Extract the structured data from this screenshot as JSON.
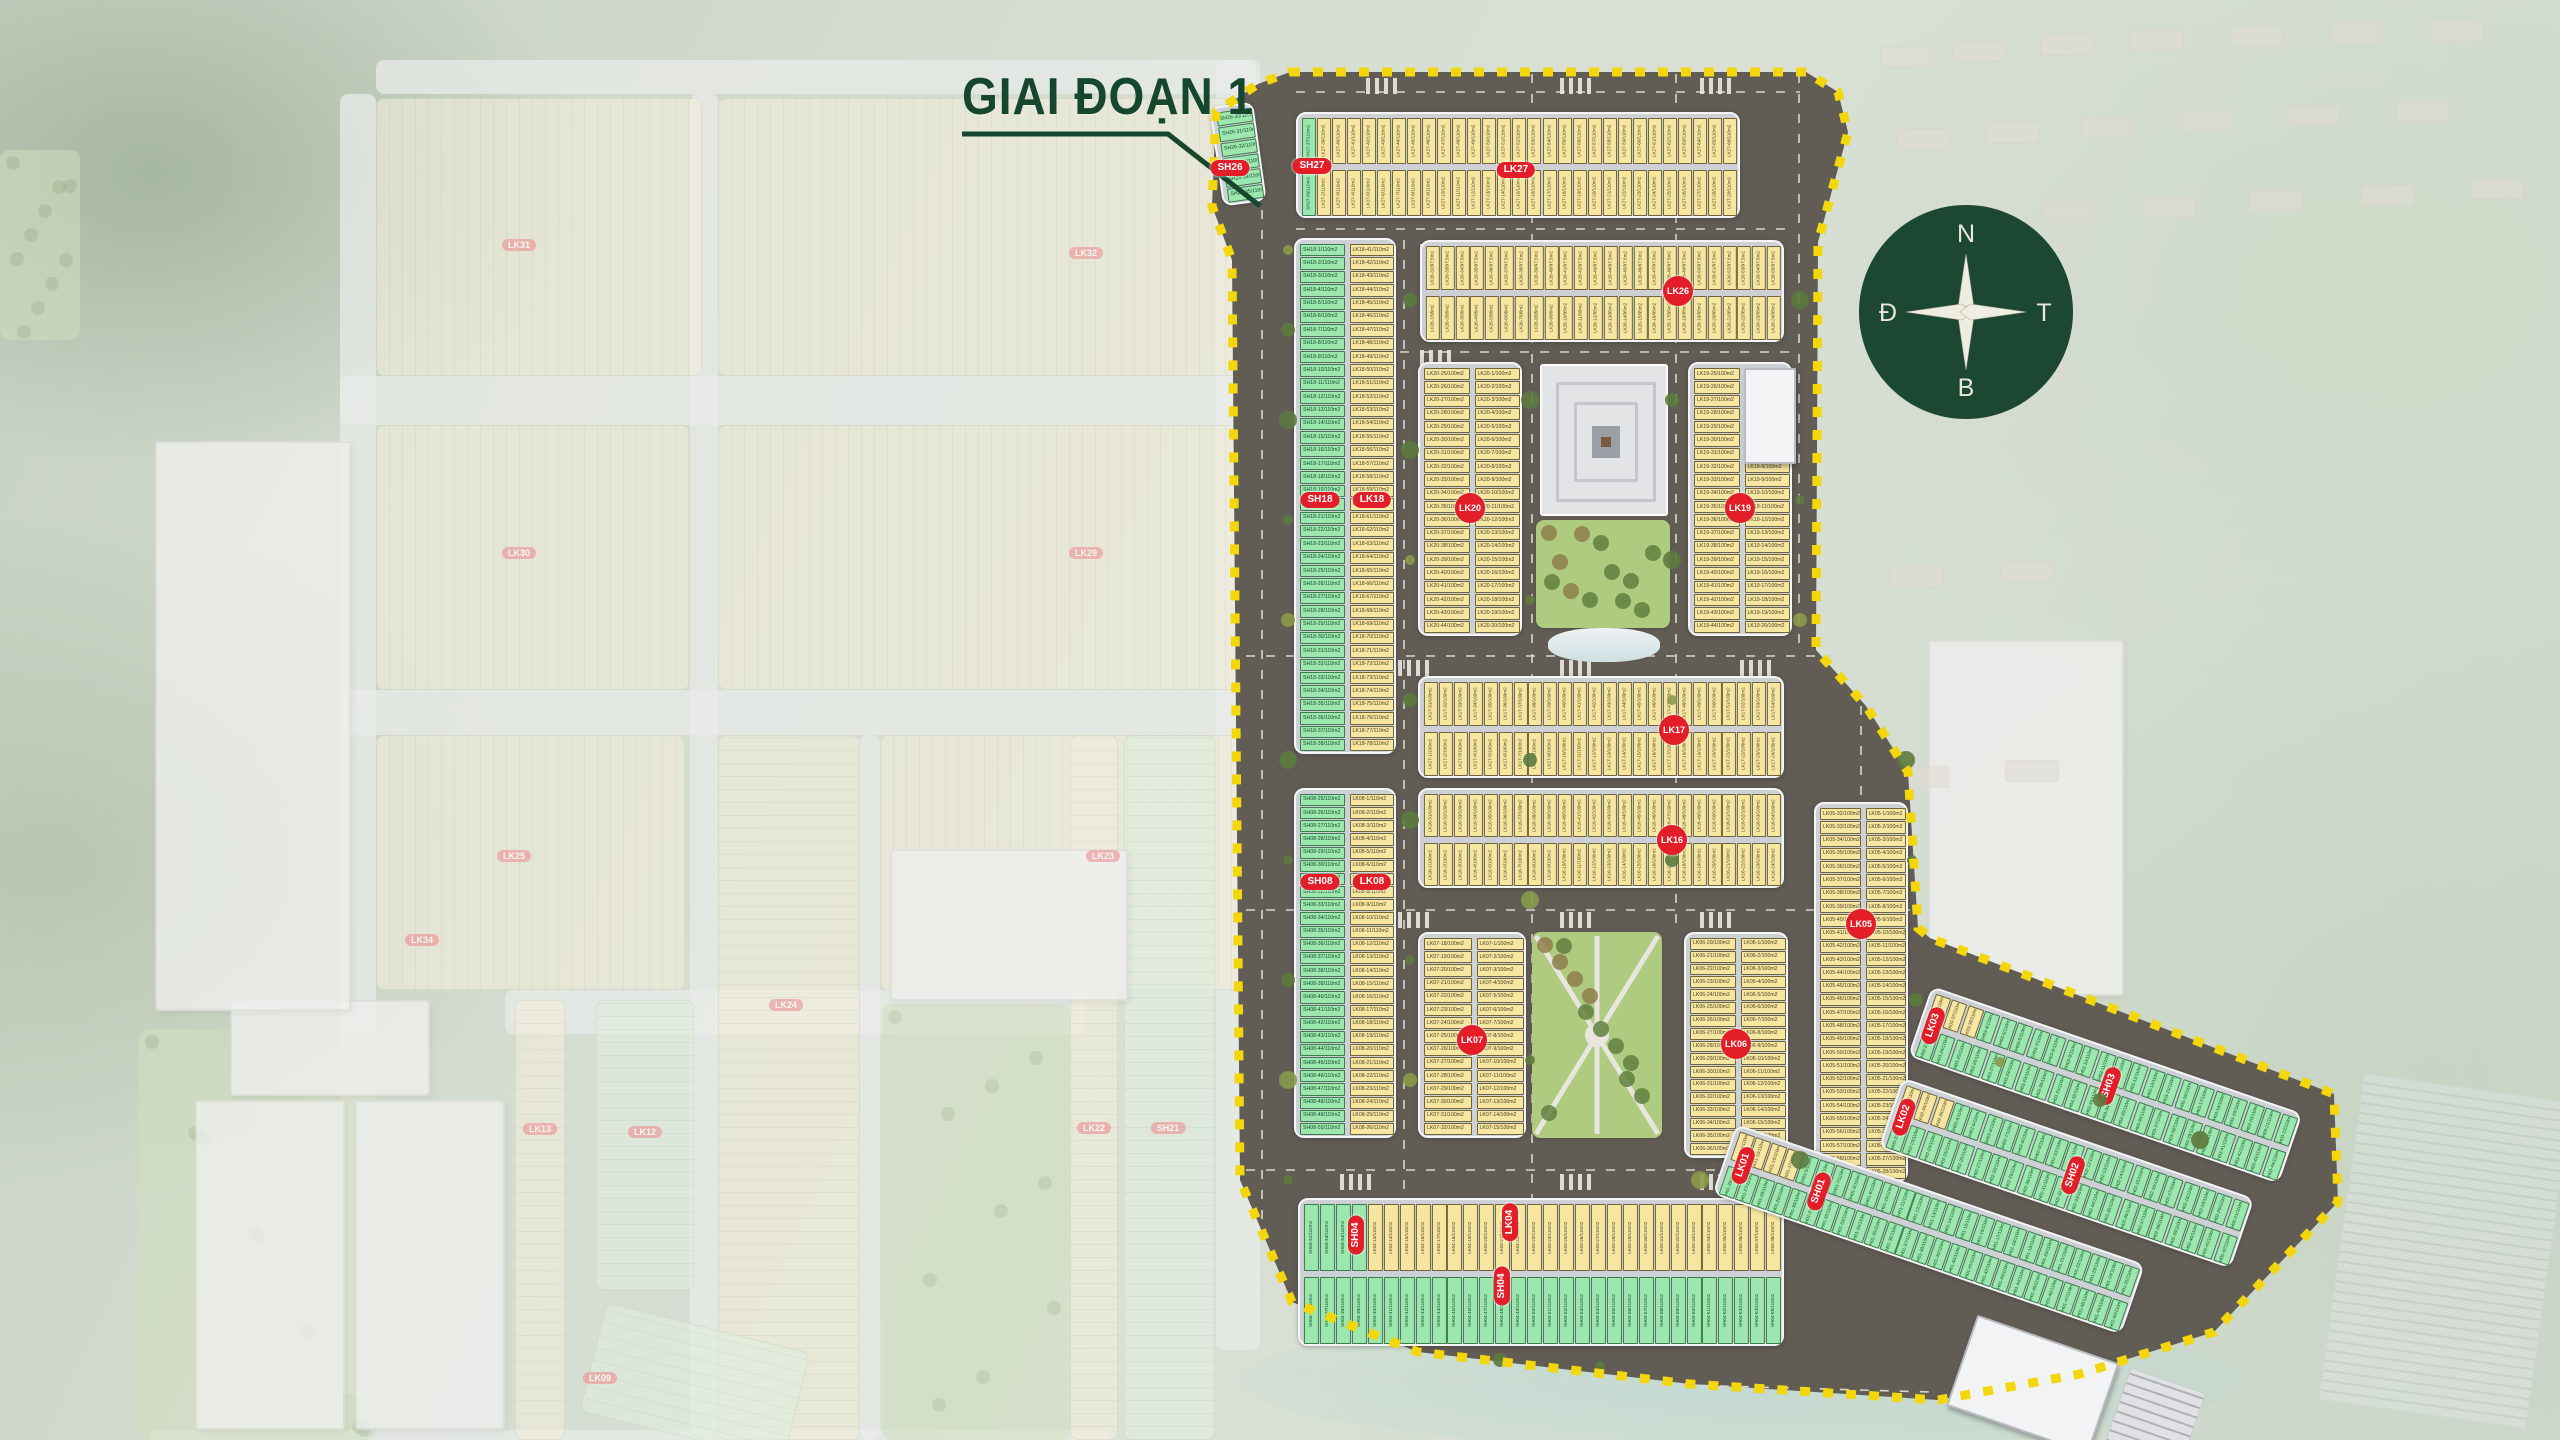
{
  "title": {
    "text": "GIAI ĐOẠN 1"
  },
  "pointer_line": [
    [
      962,
      134
    ],
    [
      1168,
      134
    ],
    [
      1260,
      206
    ]
  ],
  "compass": {
    "top": "N",
    "right": "T",
    "bottom": "B",
    "left": "Đ",
    "cx": 1966,
    "cy": 312,
    "r": 107,
    "circle_color": "#1b4733"
  },
  "colors": {
    "lot_yellow": "#f6e6a0",
    "lot_green": "#9ce7ae",
    "badge_red": "#e31e28",
    "boundary_yellow": "#f3d70b",
    "title_green": "#17462f",
    "road_dark": "#615c54",
    "platform_gray": "#cdd1d5"
  },
  "phase1": {
    "boundary": [
      [
        1290,
        72
      ],
      [
        1806,
        72
      ],
      [
        1838,
        92
      ],
      [
        1848,
        132
      ],
      [
        1818,
        242
      ],
      [
        1816,
        650
      ],
      [
        1866,
        706
      ],
      [
        1908,
        772
      ],
      [
        1918,
        928
      ],
      [
        1930,
        938
      ],
      [
        2334,
        1094
      ],
      [
        2338,
        1202
      ],
      [
        2214,
        1332
      ],
      [
        2080,
        1374
      ],
      [
        1938,
        1400
      ],
      [
        1690,
        1384
      ],
      [
        1418,
        1352
      ],
      [
        1292,
        1302
      ],
      [
        1240,
        1180
      ],
      [
        1232,
        260
      ],
      [
        1212,
        206
      ],
      [
        1216,
        112
      ],
      [
        1258,
        84
      ]
    ],
    "blocks": [
      {
        "id": "sh26",
        "x": 1216,
        "y": 104,
        "w": 44,
        "h": 100,
        "kind": "v1",
        "rot": -8,
        "m": 6,
        "cols": [
          {
            "prefix": "SH26",
            "area": "110m2",
            "color": "g",
            "start": 30
          }
        ]
      },
      {
        "id": "b27",
        "x": 1296,
        "y": 112,
        "w": 444,
        "h": 106,
        "kind": "h2",
        "n": 29,
        "rows": [
          {
            "prefix": "LK27",
            "area": "110m2",
            "color": "y",
            "start": 38,
            "greenFirst": {
              "count": 1,
              "prefix": "SH27",
              "start": 37
            }
          },
          {
            "prefix": "LK27",
            "area": "110m2",
            "color": "y",
            "start": 1,
            "greenFirst": {
              "count": 1,
              "prefix": "SH27",
              "start": 36
            }
          }
        ]
      },
      {
        "id": "b26",
        "x": 1420,
        "y": 240,
        "w": 364,
        "h": 102,
        "kind": "h2",
        "n": 24,
        "rows": [
          {
            "prefix": "LK26",
            "area": "97.5m2",
            "color": "y",
            "start": 32
          },
          {
            "prefix": "LK26",
            "area": "95m2",
            "color": "y",
            "start": 1
          }
        ]
      },
      {
        "id": "b18",
        "x": 1294,
        "y": 238,
        "w": 102,
        "h": 516,
        "kind": "v2",
        "m": 38,
        "cols": [
          {
            "prefix": "SH18",
            "area": "110m2",
            "color": "g",
            "start": 1
          },
          {
            "prefix": "LK18",
            "area": "110m2",
            "color": "y",
            "start": 41
          }
        ]
      },
      {
        "id": "b20",
        "x": 1418,
        "y": 362,
        "w": 104,
        "h": 274,
        "kind": "v2",
        "m": 20,
        "cols": [
          {
            "prefix": "LK20",
            "area": "100m2",
            "color": "y",
            "start": 25
          },
          {
            "prefix": "LK20",
            "area": "100m2",
            "color": "y",
            "start": 1
          }
        ]
      },
      {
        "id": "b19",
        "x": 1688,
        "y": 362,
        "w": 104,
        "h": 274,
        "kind": "v2",
        "m": 20,
        "cols": [
          {
            "prefix": "LK19",
            "area": "100m2",
            "color": "y",
            "start": 25
          },
          {
            "prefix": "LK19",
            "area": "100m2",
            "color": "y",
            "start": 1
          }
        ]
      },
      {
        "id": "b17",
        "x": 1418,
        "y": 676,
        "w": 366,
        "h": 102,
        "kind": "h2",
        "n": 24,
        "rows": [
          {
            "prefix": "LK17",
            "area": "100m2",
            "color": "y",
            "start": 31
          },
          {
            "prefix": "LK17",
            "area": "100m2",
            "color": "y",
            "start": 1
          }
        ]
      },
      {
        "id": "b16",
        "x": 1418,
        "y": 788,
        "w": 366,
        "h": 100,
        "kind": "h2",
        "n": 24,
        "rows": [
          {
            "prefix": "LK16",
            "area": "100m2",
            "color": "y",
            "start": 31
          },
          {
            "prefix": "LK16",
            "area": "100m2",
            "color": "y",
            "start": 1
          }
        ]
      },
      {
        "id": "b08",
        "x": 1294,
        "y": 788,
        "w": 102,
        "h": 350,
        "kind": "v2",
        "m": 26,
        "cols": [
          {
            "prefix": "SH08",
            "area": "110m2",
            "color": "g",
            "start": 25
          },
          {
            "prefix": "LK08",
            "area": "110m2",
            "color": "y",
            "start": 1
          }
        ]
      },
      {
        "id": "b07",
        "x": 1418,
        "y": 932,
        "w": 108,
        "h": 206,
        "kind": "v2",
        "m": 15,
        "cols": [
          {
            "prefix": "LK07",
            "area": "100m2",
            "color": "y",
            "start": 18
          },
          {
            "prefix": "LK07",
            "area": "100m2",
            "color": "y",
            "start": 1
          }
        ]
      },
      {
        "id": "b06",
        "x": 1684,
        "y": 932,
        "w": 104,
        "h": 226,
        "kind": "v2",
        "m": 17,
        "cols": [
          {
            "prefix": "LK06",
            "area": "100m2",
            "color": "y",
            "start": 20
          },
          {
            "prefix": "LK06",
            "area": "100m2",
            "color": "y",
            "start": 1
          }
        ]
      },
      {
        "id": "b05",
        "x": 1814,
        "y": 802,
        "w": 94,
        "h": 380,
        "kind": "v2",
        "m": 28,
        "cols": [
          {
            "prefix": "LK05",
            "area": "100m2",
            "color": "y",
            "start": 32
          },
          {
            "prefix": "LK05",
            "area": "100m2",
            "color": "y",
            "start": 1
          }
        ]
      },
      {
        "id": "b04",
        "x": 1298,
        "y": 1198,
        "w": 486,
        "h": 148,
        "kind": "h2",
        "n": 30,
        "rows": [
          {
            "prefix": "LK04",
            "area": "110m2",
            "color": "y",
            "start": 9,
            "greenFirst": {
              "count": 4,
              "prefix": "SH04",
              "start": 32
            }
          },
          {
            "prefix": "SH04",
            "area": "110m2",
            "color": "g",
            "start": 36
          }
        ]
      }
    ],
    "badges": [
      {
        "label": "SH26",
        "x": 1230,
        "y": 168,
        "shape": "oval",
        "rot": 0
      },
      {
        "label": "SH27",
        "x": 1312,
        "y": 166,
        "shape": "oval",
        "rot": 0
      },
      {
        "label": "LK27",
        "x": 1516,
        "y": 170,
        "shape": "oval",
        "rot": 0
      },
      {
        "label": "LK26",
        "x": 1678,
        "y": 291,
        "shape": "circle",
        "rot": 0
      },
      {
        "label": "SH18",
        "x": 1320,
        "y": 500,
        "shape": "oval",
        "rot": 0
      },
      {
        "label": "LK18",
        "x": 1372,
        "y": 500,
        "shape": "oval",
        "rot": 0
      },
      {
        "label": "LK20",
        "x": 1470,
        "y": 508,
        "shape": "circle",
        "rot": 0
      },
      {
        "label": "LK19",
        "x": 1740,
        "y": 508,
        "shape": "circle",
        "rot": 0
      },
      {
        "label": "LK17",
        "x": 1674,
        "y": 730,
        "shape": "circle",
        "rot": 0
      },
      {
        "label": "LK16",
        "x": 1672,
        "y": 840,
        "shape": "circle",
        "rot": 0
      },
      {
        "label": "SH08",
        "x": 1320,
        "y": 882,
        "shape": "oval",
        "rot": 0
      },
      {
        "label": "LK08",
        "x": 1372,
        "y": 882,
        "shape": "oval",
        "rot": 0
      },
      {
        "label": "LK07",
        "x": 1472,
        "y": 1040,
        "shape": "circle",
        "rot": 0
      },
      {
        "label": "LK06",
        "x": 1736,
        "y": 1044,
        "shape": "circle",
        "rot": 0
      },
      {
        "label": "LK05",
        "x": 1861,
        "y": 924,
        "shape": "circle",
        "rot": 0
      },
      {
        "label": "SH04",
        "x": 1356,
        "y": 1235,
        "shape": "oval",
        "rot": 90
      },
      {
        "label": "LK04",
        "x": 1510,
        "y": 1222,
        "shape": "oval",
        "rot": 90
      },
      {
        "label": "SH04",
        "x": 1502,
        "y": 1286,
        "shape": "oval",
        "rot": 90
      }
    ],
    "plaza": {
      "x": 1540,
      "y": 364,
      "w": 128,
      "h": 152
    },
    "parks": [
      {
        "id": "plaza-park",
        "x": 1536,
        "y": 520,
        "w": 134,
        "h": 108,
        "style": "grove"
      },
      {
        "id": "south-park",
        "x": 1532,
        "y": 932,
        "w": 130,
        "h": 206,
        "style": "paths"
      }
    ],
    "pond": {
      "x": 1548,
      "y": 628,
      "w": 112,
      "h": 34
    },
    "buildings": [
      {
        "x": 1744,
        "y": 368,
        "w": 52,
        "h": 96
      }
    ],
    "wing": {
      "x": 1932,
      "y": 986,
      "rot": 19,
      "strips": [
        {
          "id": "w3",
          "x": 0,
          "y": 0,
          "w": 392,
          "h": 74,
          "kind": "h2",
          "n": 22,
          "rows": [
            {
              "prefix": "SH03",
              "area": "110m2",
              "color": "g",
              "start": 1,
              "yellowFirst": {
                "count": 3,
                "prefix": "LK03",
                "start": 36
              }
            },
            {
              "prefix": "SH03",
              "area": "110m2",
              "color": "g",
              "start": 23
            }
          ]
        },
        {
          "id": "w2",
          "x": 2,
          "y": 96,
          "w": 372,
          "h": 74,
          "kind": "h2",
          "n": 21,
          "rows": [
            {
              "prefix": "SH02",
              "area": "110m2",
              "color": "g",
              "start": 1,
              "yellowFirst": {
                "count": 3,
                "prefix": "LK02",
                "start": 33
              }
            },
            {
              "prefix": "SH02",
              "area": "110m2",
              "color": "g",
              "start": 22
            }
          ]
        },
        {
          "id": "w1",
          "x": -140,
          "y": 194,
          "w": 432,
          "h": 74,
          "kind": "h2",
          "n": 25,
          "rows": [
            {
              "prefix": "SH01",
              "area": "110m2",
              "color": "g",
              "start": 1,
              "yellowFirst": {
                "count": 4,
                "prefix": "LK01",
                "start": 14
              }
            },
            {
              "prefix": "SH01",
              "area": "110m2",
              "color": "g",
              "start": 26
            }
          ]
        }
      ],
      "badges": [
        {
          "label": "LK03",
          "x": 14,
          "y": 37,
          "rot": 90
        },
        {
          "label": "SH03",
          "x": 200,
          "y": 37,
          "rot": 90
        },
        {
          "label": "LK02",
          "x": 16,
          "y": 133,
          "rot": 90
        },
        {
          "label": "SH02",
          "x": 195,
          "y": 133,
          "rot": 90
        },
        {
          "label": "LK01",
          "x": -120,
          "y": 231,
          "rot": 90
        },
        {
          "label": "SH01",
          "x": -40,
          "y": 231,
          "rot": 90
        }
      ],
      "building": {
        "x": 150,
        "y": 296,
        "w": 150,
        "h": 96
      },
      "parking": {
        "x": 312,
        "y": 296,
        "w": 80,
        "h": 96
      }
    }
  },
  "faded": {
    "roads": [
      [
        376,
        60,
        880,
        34
      ],
      [
        340,
        376,
        915,
        49
      ],
      [
        340,
        690,
        915,
        45
      ],
      [
        505,
        990,
        580,
        44
      ],
      [
        340,
        94,
        36,
        1300
      ],
      [
        690,
        94,
        28,
        1340
      ],
      [
        860,
        735,
        20,
        705
      ],
      [
        1216,
        60,
        44,
        1290
      ],
      [
        150,
        1430,
        960,
        30
      ]
    ],
    "blocks": [
      {
        "x": 376,
        "y": 98,
        "w": 326,
        "h": 278,
        "cls": "y"
      },
      {
        "x": 718,
        "y": 98,
        "w": 531,
        "h": 278,
        "cls": "y"
      },
      {
        "x": 376,
        "y": 425,
        "w": 314,
        "h": 265,
        "cls": "y"
      },
      {
        "x": 718,
        "y": 425,
        "w": 531,
        "h": 265,
        "cls": "y"
      },
      {
        "x": 376,
        "y": 735,
        "w": 309,
        "h": 255,
        "cls": "y"
      },
      {
        "x": 880,
        "y": 735,
        "w": 369,
        "h": 255,
        "cls": "y"
      },
      {
        "x": 718,
        "y": 735,
        "w": 142,
        "h": 705,
        "cls": "yh"
      },
      {
        "x": 1070,
        "y": 735,
        "w": 48,
        "h": 705,
        "cls": "yh"
      },
      {
        "x": 1124,
        "y": 735,
        "w": 91,
        "h": 705,
        "cls": "g"
      },
      {
        "x": 515,
        "y": 1000,
        "w": 50,
        "h": 440,
        "cls": "yh"
      },
      {
        "x": 596,
        "y": 1000,
        "w": 98,
        "h": 290,
        "cls": "g"
      },
      {
        "x": 590,
        "y": 1326,
        "w": 210,
        "h": 112,
        "cls": "g",
        "rot": 14
      }
    ],
    "parks": [
      {
        "x": 139,
        "y": 1029,
        "w": 237,
        "h": 411
      },
      {
        "x": 882,
        "y": 1004,
        "w": 188,
        "h": 436
      },
      {
        "x": 0,
        "y": 150,
        "w": 80,
        "h": 190
      }
    ],
    "buildings": [
      {
        "x": 230,
        "y": 1000,
        "w": 200,
        "h": 96
      },
      {
        "x": 195,
        "y": 1100,
        "w": 150,
        "h": 330
      },
      {
        "x": 355,
        "y": 1100,
        "w": 150,
        "h": 330
      },
      {
        "x": 890,
        "y": 849,
        "w": 238,
        "h": 152
      },
      {
        "x": 155,
        "y": 441,
        "w": 196,
        "h": 570
      },
      {
        "x": 1928,
        "y": 640,
        "w": 196,
        "h": 356
      }
    ],
    "badges": [
      {
        "label": "LK31",
        "x": 519,
        "y": 245
      },
      {
        "label": "LK32",
        "x": 1086,
        "y": 253
      },
      {
        "label": "LK30",
        "x": 519,
        "y": 553
      },
      {
        "label": "LK29",
        "x": 1086,
        "y": 553
      },
      {
        "label": "LK25",
        "x": 514,
        "y": 856
      },
      {
        "label": "LK23",
        "x": 1103,
        "y": 856
      },
      {
        "label": "LK24",
        "x": 786,
        "y": 1005
      },
      {
        "label": "LK22",
        "x": 1094,
        "y": 1128
      },
      {
        "label": "SH21",
        "x": 1168,
        "y": 1128
      },
      {
        "label": "LK34",
        "x": 422,
        "y": 940
      },
      {
        "label": "LK13",
        "x": 540,
        "y": 1129
      },
      {
        "label": "LK12",
        "x": 645,
        "y": 1132
      },
      {
        "label": "LK09",
        "x": 600,
        "y": 1378,
        "rot": 90
      }
    ],
    "houses": [
      [
        1880,
        46
      ],
      [
        1952,
        40
      ],
      [
        2040,
        34
      ],
      [
        2130,
        30
      ],
      [
        2230,
        26
      ],
      [
        2330,
        22
      ],
      [
        2430,
        20
      ],
      [
        1896,
        128
      ],
      [
        1986,
        122
      ],
      [
        2082,
        116
      ],
      [
        2180,
        110
      ],
      [
        2286,
        104
      ],
      [
        2396,
        100
      ],
      [
        1946,
        208
      ],
      [
        2042,
        202
      ],
      [
        2142,
        196
      ],
      [
        2248,
        190
      ],
      [
        2360,
        184
      ],
      [
        2470,
        178
      ],
      [
        1900,
        356
      ],
      [
        2010,
        350
      ],
      [
        1890,
        566
      ],
      [
        2000,
        560
      ],
      [
        1895,
        766
      ],
      [
        2005,
        760
      ]
    ],
    "parking_lot": {
      "x": 2340,
      "y": 1086,
      "w": 210,
      "h": 330
    },
    "water": {
      "x": 1240,
      "y": 1310,
      "w": 1000,
      "h": 140
    }
  }
}
